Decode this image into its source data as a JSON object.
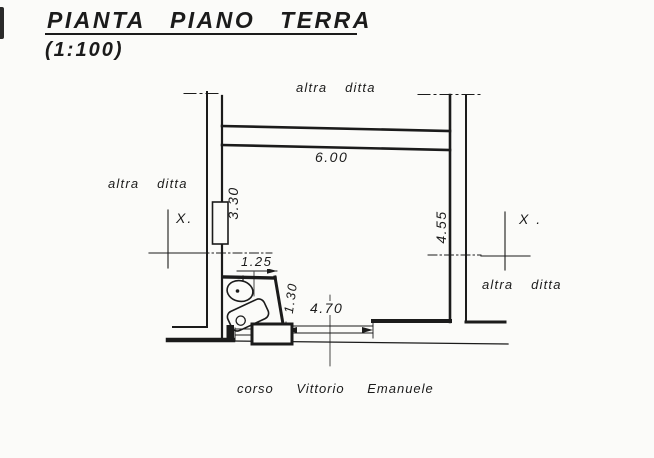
{
  "title": {
    "text": "PIANTA PIANO TERRA",
    "scale": "(1:100)"
  },
  "plan": {
    "neighbor_top": "altra ditta",
    "neighbor_left": "altra ditta",
    "neighbor_right": "altra ditta",
    "street": "corso Vittorio Emanuele",
    "section_mark_left": "X.",
    "section_mark_right": "X .",
    "dims": {
      "room_width": "6.00",
      "left_wall_height": "3.30",
      "right_wall_height": "4.55",
      "bath_width": "1.25",
      "bath_depth": "1.30",
      "shopfront_width": "4.70"
    }
  },
  "colors": {
    "ink": "#1b1b1b",
    "paper": "#fbfbf9"
  }
}
